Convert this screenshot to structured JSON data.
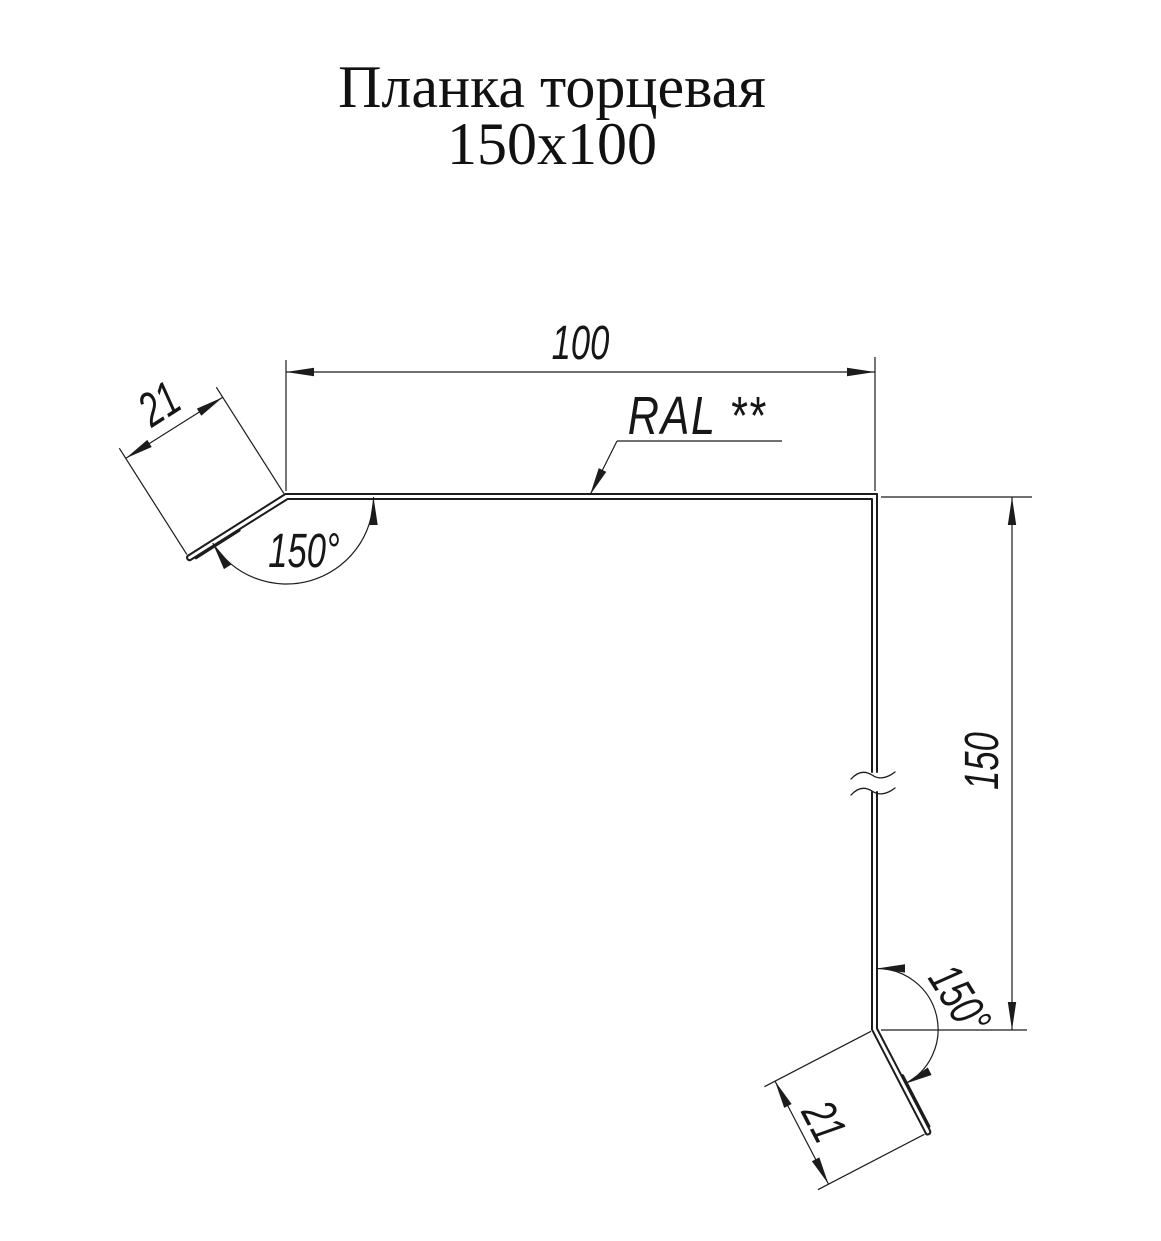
{
  "title": {
    "line1": "Планка торцевая",
    "line2": "150x100"
  },
  "annotations": {
    "material": "RAL **"
  },
  "dimensions": {
    "width": "100",
    "height": "150",
    "flange_top": "21",
    "flange_bottom": "21",
    "angle_top": "150°",
    "angle_bottom": "150°"
  },
  "colors": {
    "ink": "#1c1c1c",
    "background": "#ffffff"
  }
}
